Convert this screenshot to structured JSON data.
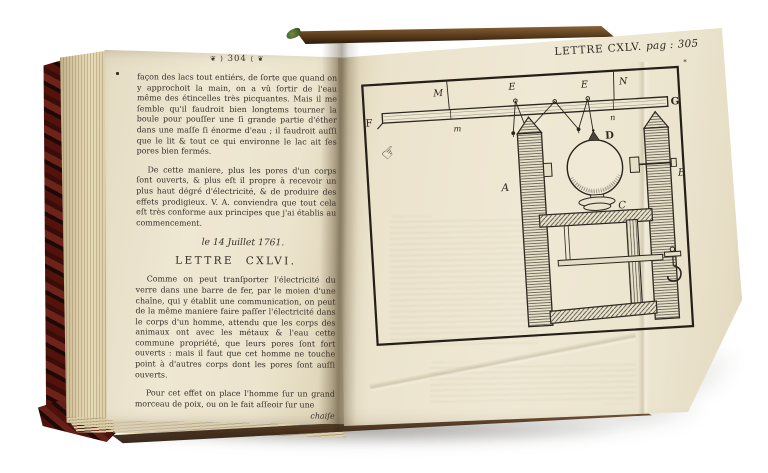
{
  "photo": {
    "backdrop_color": "#ffffff",
    "page_color": "#ece4cd",
    "ink_color": "#35302a",
    "cover_color": "#5c170f",
    "fore_edge_color": "#d8cba4"
  },
  "left_page": {
    "running_head": {
      "ornament_left": "❦ )",
      "page_number": "304",
      "ornament_right": "( ❦"
    },
    "paragraph_1": "façon des lacs tout entiérs, de ſorte que quand on y approchoit la main, on a vû ſortir de l'eau même des étincelles très picquantes. Mais il me ſemble qu'il faudroit bien longtems tourner la boule pour pouſſer une ſi grande partie d'éther dans une maſſe ſi énorme d'eau ; il faudroit auſſi que le lit & tout ce qui environne le lac ait ſes pores bien fermés.",
    "paragraph_2": "De cette maniere, plus les pores d'un corps ſont ouverts, & plus eſt il propre à recevoir un plus haut dégré d'électricité, & de produire des effets prodigieux. V. A. conviendra que tout cela eſt très conforme aux principes que j'ai établis au commencement.",
    "date_line": "le 14 Juillet 1761.",
    "section_heading": "LETTRE CXLVI.",
    "paragraph_3": "Comme on peut tranſporter l'électricité du verre dans une barre de fer, par le moien d'une chaîne, qui y établit une communication, on peut de la même maniere faire paſſer l'électricité dans le corps d'un homme, attendu que les corps des animaux ont avec les métaux & l'eau cette commune propriété, que leurs pores ſont fort ouverts : mais il faut que cet homme ne touche point à d'autres corps dont les pores ſont auſſi ouverts.",
    "paragraph_4": "Pour cet effet on place l'homme ſur un grand morceau de poix, ou on le fait aſſeoir ſur une",
    "catchword": "chaiſe"
  },
  "right_page": {
    "running_head": {
      "title": "LETTRE CXLV.",
      "pag_label": "pag :",
      "page_number": "305"
    },
    "printer_mark": "*",
    "hand_glyph": "☞",
    "figure_labels": {
      "F": "F",
      "G": "G",
      "M": "M",
      "N": "N",
      "E_left": "E",
      "E_right": "E",
      "m": "m",
      "n": "n",
      "A": "A",
      "B": "B",
      "C": "C",
      "D": "D"
    }
  }
}
